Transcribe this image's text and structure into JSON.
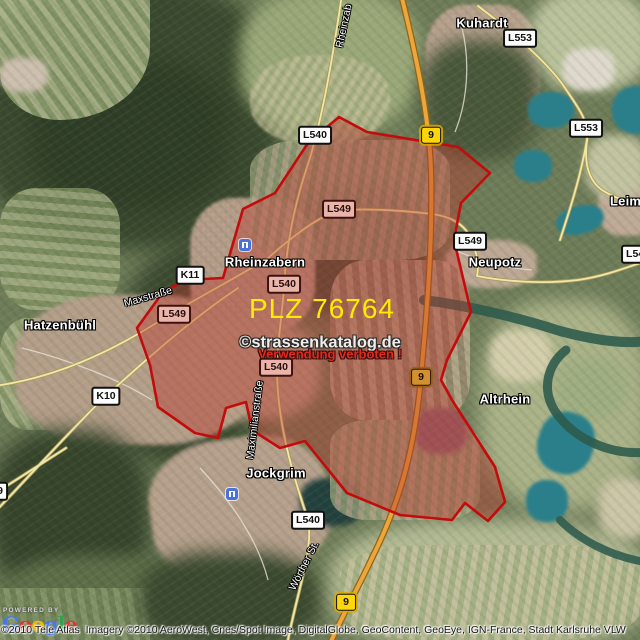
{
  "map": {
    "plz_label": "PLZ 76764",
    "watermark": {
      "line1": "©strassenkatalog.de",
      "line2": "Verwendung verboten !"
    },
    "places": [
      {
        "id": "kuhardt",
        "label": "Kuhardt",
        "x": 482,
        "y": 23
      },
      {
        "id": "rheinzabern",
        "label": "Rheinzabern",
        "x": 265,
        "y": 262
      },
      {
        "id": "hatzenbuehl",
        "label": "Hatzenbühl",
        "x": 60,
        "y": 325
      },
      {
        "id": "neupotz",
        "label": "Neupotz",
        "x": 495,
        "y": 262
      },
      {
        "id": "jockgrim",
        "label": "Jockgrim",
        "x": 276,
        "y": 473
      },
      {
        "id": "altrhein",
        "label": "Altrhein",
        "x": 505,
        "y": 399
      },
      {
        "id": "leimersheim",
        "label": "Leimers",
        "x": 610,
        "y": 201,
        "anchor": "left"
      }
    ],
    "streets": [
      {
        "id": "rheinzaberner-str",
        "label": "Rheinzab",
        "x": 344,
        "y": 26,
        "rot": -78
      },
      {
        "id": "maxstrasse",
        "label": "Maxstraße",
        "x": 148,
        "y": 297,
        "rot": -16
      },
      {
        "id": "maximilianstrasse",
        "label": "Maximilianstraße",
        "x": 255,
        "y": 420,
        "rot": -83
      },
      {
        "id": "woerther-st",
        "label": "Wörther St.",
        "x": 304,
        "y": 566,
        "rot": -63
      }
    ],
    "badges": [
      {
        "label": "L540",
        "x": 315,
        "y": 135,
        "type": "white"
      },
      {
        "label": "L553",
        "x": 520,
        "y": 38,
        "type": "white"
      },
      {
        "label": "L553",
        "x": 586,
        "y": 128,
        "type": "white"
      },
      {
        "label": "K11",
        "x": 190,
        "y": 275,
        "type": "white"
      },
      {
        "label": "L540",
        "x": 284,
        "y": 284,
        "type": "tinted"
      },
      {
        "label": "L549",
        "x": 174,
        "y": 314,
        "type": "tinted"
      },
      {
        "label": "L549",
        "x": 339,
        "y": 209,
        "type": "tinted"
      },
      {
        "label": "L549",
        "x": 470,
        "y": 241,
        "type": "white"
      },
      {
        "label": "L540",
        "x": 276,
        "y": 367,
        "type": "tinted"
      },
      {
        "label": "K10",
        "x": 106,
        "y": 396,
        "type": "white"
      },
      {
        "label": "L540",
        "x": 308,
        "y": 520,
        "type": "white"
      },
      {
        "label": "L540",
        "x": 638,
        "y": 254,
        "type": "white"
      },
      {
        "label": "9",
        "x": 0,
        "y": 491,
        "type": "white"
      },
      {
        "label": "9",
        "x": 431,
        "y": 135,
        "type": "yellow"
      },
      {
        "label": "9",
        "x": 421,
        "y": 377,
        "type": "yellow-tinted"
      },
      {
        "label": "9",
        "x": 346,
        "y": 602,
        "type": "yellow"
      }
    ],
    "stations": [
      {
        "x": 245,
        "y": 245
      },
      {
        "x": 232,
        "y": 494
      }
    ]
  },
  "attribution": {
    "powered_by": "POWERED BY",
    "logo_letters": [
      {
        "ch": "G",
        "c": "#4477f1"
      },
      {
        "ch": "o",
        "c": "#e4332a"
      },
      {
        "ch": "o",
        "c": "#f6b900"
      },
      {
        "ch": "g",
        "c": "#4477f1"
      },
      {
        "ch": "l",
        "c": "#30a14e"
      },
      {
        "ch": "e",
        "c": "#e4332a"
      }
    ],
    "copyright": "©2010 Tele Atlas  Imagery ©2010 AeroWest, Cnes/Spot Image, DigitalGlobe, GeoContent, GeoEye, IGN-France, Stadt Karlsruhe VLW"
  },
  "colors": {
    "plz-fill": "rgba(186,55,45,0.42)",
    "plz-stroke": "#c40b0b",
    "plz-text": "#ffec00",
    "watermark-text": "#efede8",
    "warning-text": "#e8281a",
    "road-b9": "#eda63c",
    "road-b9-casing": "#8f6516",
    "road-l": "#f1e7a6",
    "road-l-casing": "#a89a5c",
    "road-minor": "#e7e2d6",
    "river": "#2d5a4c",
    "lake": "#2a7f8a",
    "badge-yellow": "#ffd60a",
    "station-blue": "#4a72d8"
  }
}
